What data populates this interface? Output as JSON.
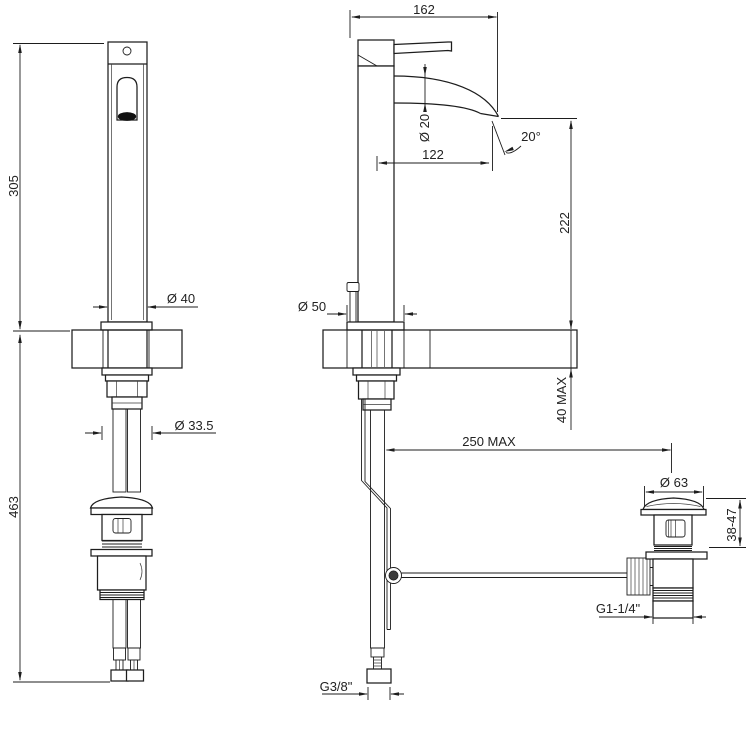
{
  "colors": {
    "background": "#ffffff",
    "line": "#1d1d1d",
    "text": "#222222"
  },
  "dimensions": {
    "front_height": "305",
    "below_deck_height": "463",
    "body_diameter": "Ø 40",
    "shank_diameter": "Ø 33.5",
    "overall_depth": "162",
    "spout_diameter": "Ø 20",
    "spout_reach": "122",
    "flow_angle": "20°",
    "outlet_height": "222",
    "deck_thickness": "40 MAX",
    "base_diameter": "Ø 50",
    "rod_reach": "250 MAX",
    "drain_cap_diameter": "Ø 63",
    "drain_height_range": "38-47",
    "drain_thread": "G1-1/4\"",
    "supply_thread": "G3/8\""
  }
}
